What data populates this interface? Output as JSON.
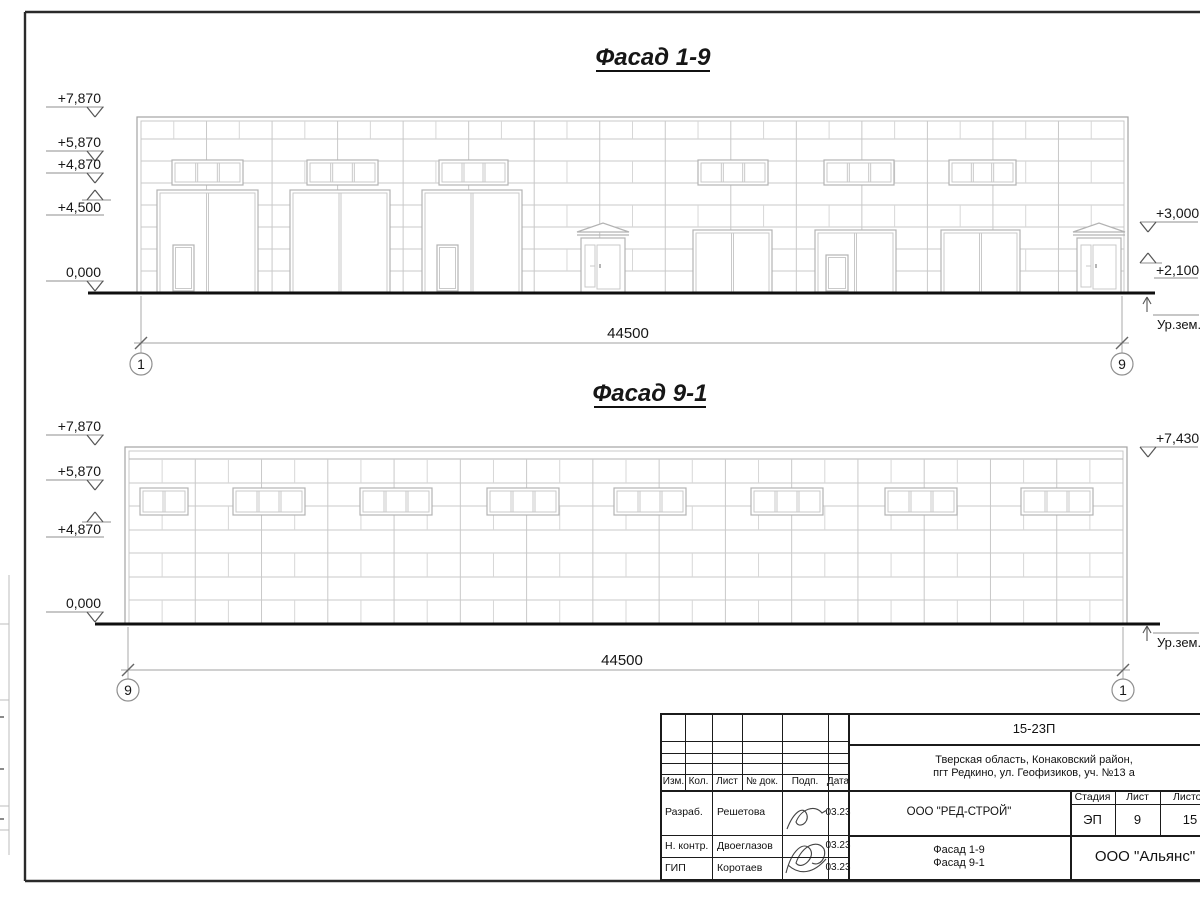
{
  "facades": [
    {
      "title": "Фасад 1-9",
      "dimension_label": "44500",
      "axis_left": "1",
      "axis_right": "9",
      "ground_label": "Ур.зем.",
      "left_marks": [
        {
          "label": "+7,870",
          "level": 117,
          "dir": "down"
        },
        {
          "label": "+5,870",
          "level": 161,
          "dir": "down"
        },
        {
          "label": "+4,870",
          "level": 183,
          "dir": "down"
        },
        {
          "label": "+4,500",
          "level": 190,
          "dir": "up"
        },
        {
          "label": "0,000",
          "level": 291,
          "dir": "down"
        }
      ],
      "right_marks": [
        {
          "label": "+3,000",
          "level": 232,
          "dir": "down"
        },
        {
          "label": "+2,100",
          "level": 253,
          "dir": "up"
        }
      ]
    },
    {
      "title": "Фасад 9-1",
      "dimension_label": "44500",
      "axis_left": "9",
      "axis_right": "1",
      "ground_label": "Ур.зем.",
      "left_marks": [
        {
          "label": "+7,870",
          "level": 445,
          "dir": "down"
        },
        {
          "label": "+5,870",
          "level": 490,
          "dir": "down"
        },
        {
          "label": "+4,870",
          "level": 512,
          "dir": "up"
        },
        {
          "label": "0,000",
          "level": 622,
          "dir": "down"
        }
      ],
      "right_marks": [
        {
          "label": "+7,430",
          "level": 457,
          "dir": "down"
        }
      ]
    }
  ],
  "titleblock": {
    "doc_number": "15-23П",
    "address_line1": "Тверская область, Конаковский район,",
    "address_line2": "пгт Редкино, ул. Геофизиков, уч. №13 а",
    "col_izm": "Изм.",
    "col_kol": "Кол.",
    "col_list": "Лист",
    "col_doc": "№ док.",
    "col_podp": "Подп.",
    "col_data": "Дата",
    "row1_role": "Разраб.",
    "row1_name": "Решетова",
    "row1_date": "03.23",
    "row2_role": "Н. контр.",
    "row2_name": "Двоеглазов",
    "row2_date": "03.23",
    "row3_role": "ГИП",
    "row3_name": "Коротаев",
    "row3_date": "03.23",
    "company": "ООО \"РЕД-СТРОЙ\"",
    "stage_label": "Стадия",
    "sheet_label": "Лист",
    "sheets_label": "Листов",
    "stage": "ЭП",
    "sheet": "9",
    "sheets": "15",
    "sheet_title_line1": "Фасад 1-9",
    "sheet_title_line2": "Фасад 9-1",
    "org": "ООО \"Альянс\""
  }
}
